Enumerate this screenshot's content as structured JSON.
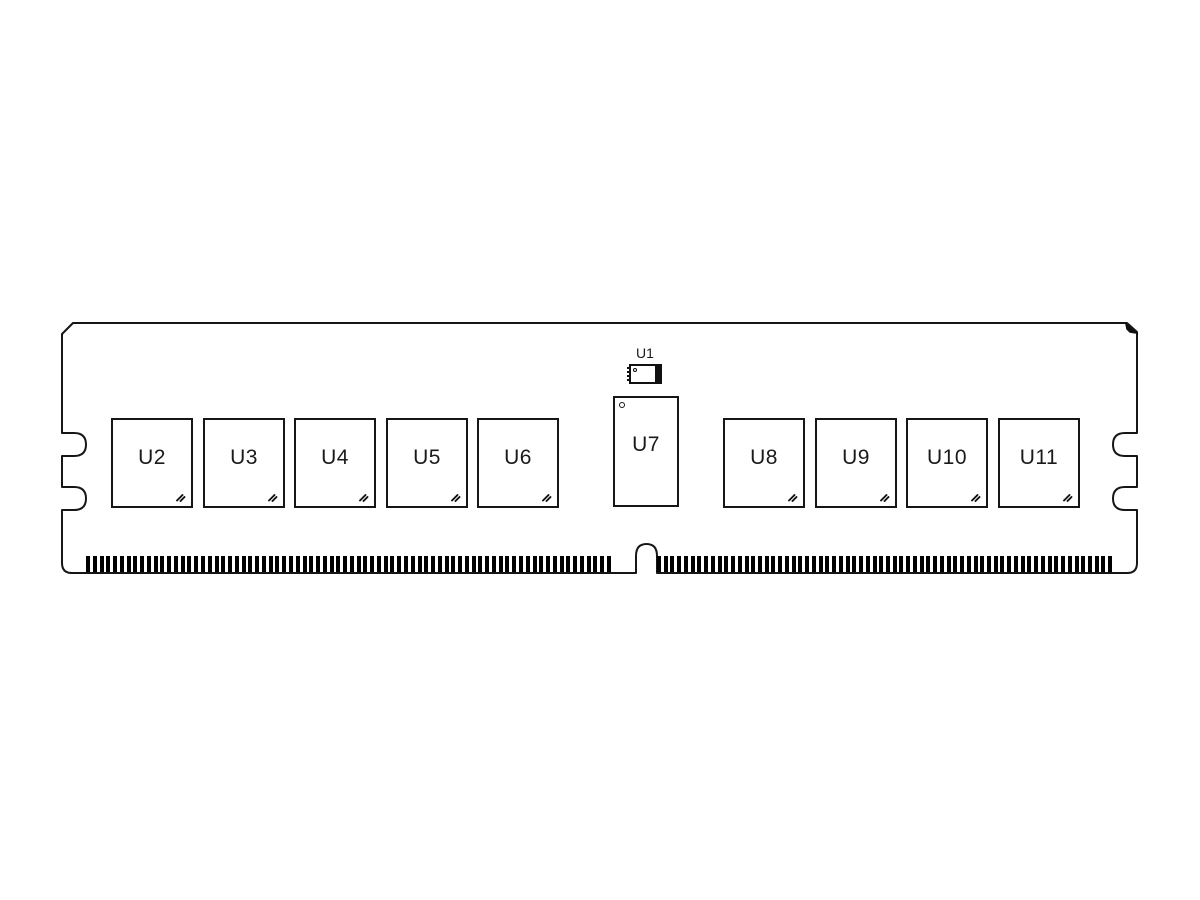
{
  "chips": [
    {
      "id": "U2"
    },
    {
      "id": "U3"
    },
    {
      "id": "U4"
    },
    {
      "id": "U5"
    },
    {
      "id": "U6"
    },
    {
      "id": "U8"
    },
    {
      "id": "U9"
    },
    {
      "id": "U10"
    },
    {
      "id": "U11"
    }
  ],
  "chip_tall": {
    "id": "U7"
  },
  "chip_small": {
    "id": "U1"
  },
  "connector": {
    "left_pin_count": 78,
    "right_pin_count": 68
  },
  "colors": {
    "line": "#161616",
    "pin": "#000000",
    "fill": "#ffffff",
    "background": "#ffffff"
  }
}
